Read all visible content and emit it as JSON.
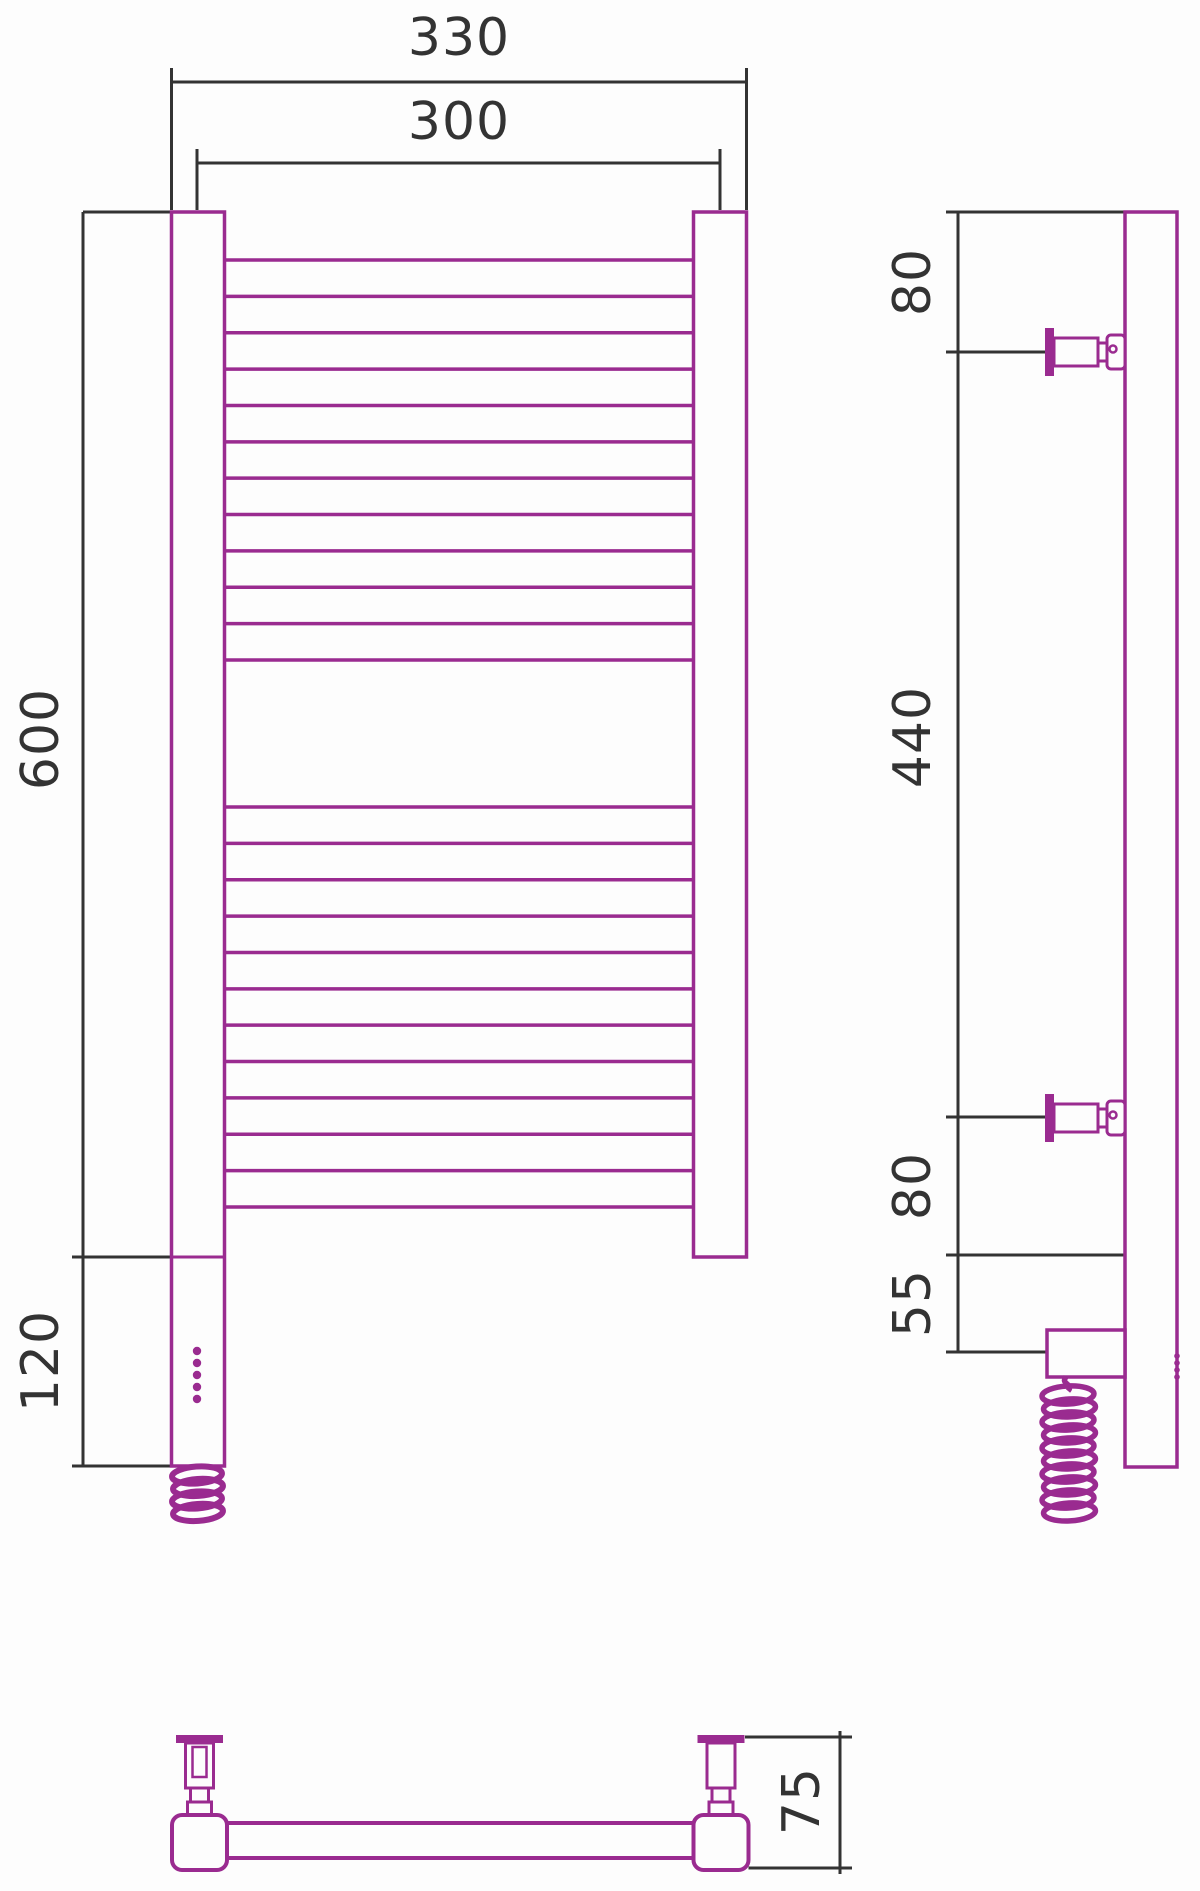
{
  "drawing": {
    "type": "technical-dimension-drawing",
    "subject": "ladder-style electric heated towel rail, three orthographic views",
    "colors": {
      "product_outline": "#9a2b90",
      "dimension_lines": "#333333",
      "background": "#fdfdfd"
    },
    "front_view": {
      "outer_width_label": "330",
      "inner_width_label": "300",
      "height_label": "600",
      "heater_section_label": "120",
      "rung_groups": [
        {
          "count": 12
        },
        {
          "count": 12
        }
      ],
      "led_dot_count": 5
    },
    "side_view": {
      "top_bracket_offset_label": "80",
      "bracket_span_label": "440",
      "bottom_bracket_offset_label": "80",
      "heater_offset_label": "55",
      "led_dot_count": 4
    },
    "bottom_view": {
      "depth_label": "75"
    }
  }
}
